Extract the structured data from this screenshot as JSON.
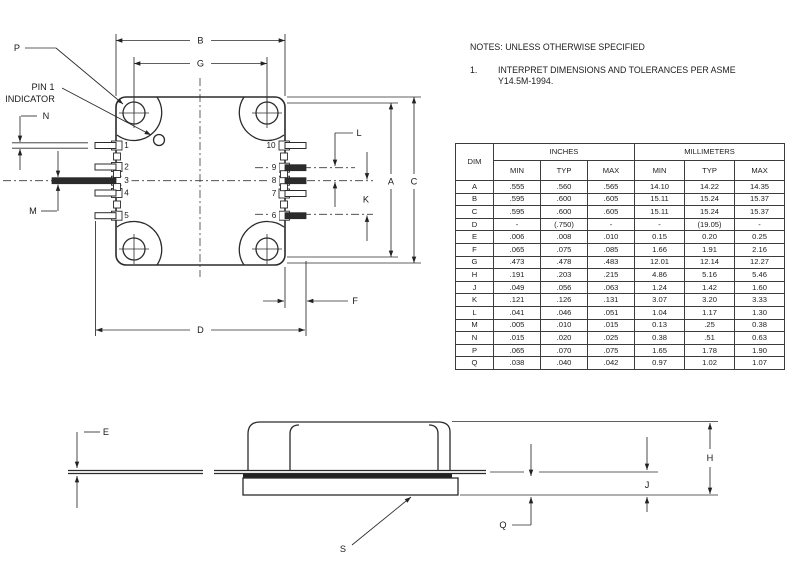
{
  "notes": {
    "title": "NOTES: UNLESS OTHERWISE SPECIFIED",
    "item_number": "1.",
    "item_line1": "INTERPRET DIMENSIONS AND TOLERANCES PER ASME",
    "item_line2": "Y14.5M-1994."
  },
  "table": {
    "headers": {
      "dim": "DIM",
      "inches": "INCHES",
      "millimeters": "MILLIMETERS"
    },
    "sub_headers": [
      "MIN",
      "TYP",
      "MAX",
      "MIN",
      "TYP",
      "MAX"
    ],
    "rows": [
      {
        "dim": "A",
        "inches": [
          ".555",
          ".560",
          ".565"
        ],
        "mm": [
          "14.10",
          "14.22",
          "14.35"
        ]
      },
      {
        "dim": "B",
        "inches": [
          ".595",
          ".600",
          ".605"
        ],
        "mm": [
          "15.11",
          "15.24",
          "15.37"
        ]
      },
      {
        "dim": "C",
        "inches": [
          ".595",
          ".600",
          ".605"
        ],
        "mm": [
          "15.11",
          "15.24",
          "15.37"
        ]
      },
      {
        "dim": "D",
        "inches": [
          "-",
          "(.750)",
          "-"
        ],
        "mm": [
          "-",
          "(19.05)",
          "-"
        ]
      },
      {
        "dim": "E",
        "inches": [
          ".006",
          ".008",
          ".010"
        ],
        "mm": [
          "0.15",
          "0.20",
          "0.25"
        ]
      },
      {
        "dim": "F",
        "inches": [
          ".065",
          ".075",
          ".085"
        ],
        "mm": [
          "1.66",
          "1.91",
          "2.16"
        ]
      },
      {
        "dim": "G",
        "inches": [
          ".473",
          ".478",
          ".483"
        ],
        "mm": [
          "12.01",
          "12.14",
          "12.27"
        ]
      },
      {
        "dim": "H",
        "inches": [
          ".191",
          ".203",
          ".215"
        ],
        "mm": [
          "4.86",
          "5.16",
          "5.46"
        ]
      },
      {
        "dim": "J",
        "inches": [
          ".049",
          ".056",
          ".063"
        ],
        "mm": [
          "1.24",
          "1.42",
          "1.60"
        ]
      },
      {
        "dim": "K",
        "inches": [
          ".121",
          ".126",
          ".131"
        ],
        "mm": [
          "3.07",
          "3.20",
          "3.33"
        ]
      },
      {
        "dim": "L",
        "inches": [
          ".041",
          ".046",
          ".051"
        ],
        "mm": [
          "1.04",
          "1.17",
          "1.30"
        ]
      },
      {
        "dim": "M",
        "inches": [
          ".005",
          ".010",
          ".015"
        ],
        "mm": [
          "0.13",
          ".25",
          "0.38"
        ]
      },
      {
        "dim": "N",
        "inches": [
          ".015",
          ".020",
          ".025"
        ],
        "mm": [
          "0.38",
          ".51",
          "0.63"
        ]
      },
      {
        "dim": "P",
        "inches": [
          ".065",
          ".070",
          ".075"
        ],
        "mm": [
          "1.65",
          "1.78",
          "1.90"
        ]
      },
      {
        "dim": "Q",
        "inches": [
          ".038",
          ".040",
          ".042"
        ],
        "mm": [
          "0.97",
          "1.02",
          "1.07"
        ]
      }
    ]
  },
  "top_view": {
    "labels": {
      "B": "B",
      "G": "G",
      "A": "A",
      "C": "C",
      "K": "K",
      "L": "L",
      "F": "F",
      "D": "D",
      "N": "N",
      "M": "M",
      "P": "P",
      "pin1_line1": "PIN 1",
      "pin1_line2": "INDICATOR"
    },
    "pins_left": [
      "1",
      "2",
      "3",
      "4",
      "5"
    ],
    "pins_right": [
      "10",
      "9",
      "8",
      "7",
      "6"
    ]
  },
  "side_view": {
    "labels": {
      "E": "E",
      "H": "H",
      "J": "J",
      "Q": "Q",
      "S": "S"
    }
  },
  "colors": {
    "line": "#2b2b2b",
    "background": "#ffffff"
  }
}
